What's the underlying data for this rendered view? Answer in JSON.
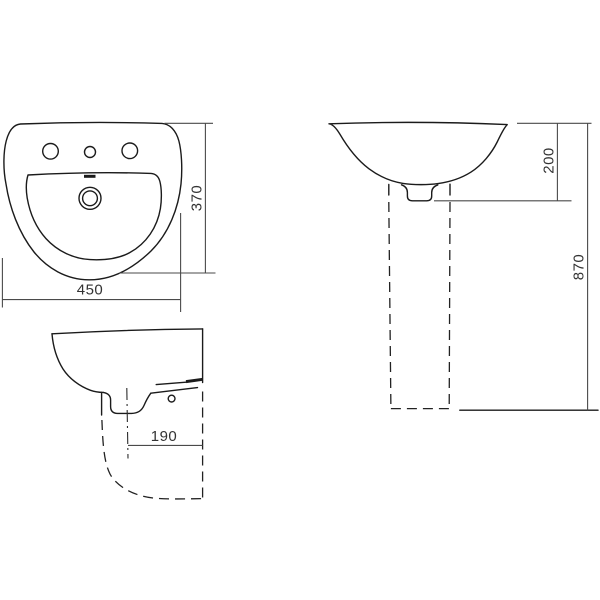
{
  "page": {
    "background": "#ffffff"
  },
  "drawing": {
    "type": "technical-dimension-drawing",
    "subject": "pedestal-washbasin-three-views",
    "line_color": "#1b1b1b",
    "dimension_line_color": "#4a4a4a",
    "text_color": "#333333",
    "top_view": {
      "width_label": "450",
      "depth_label": "370"
    },
    "side_view": {
      "projection_label": "190"
    },
    "front_view": {
      "basin_height_label": "200",
      "total_height_label": "870"
    }
  }
}
